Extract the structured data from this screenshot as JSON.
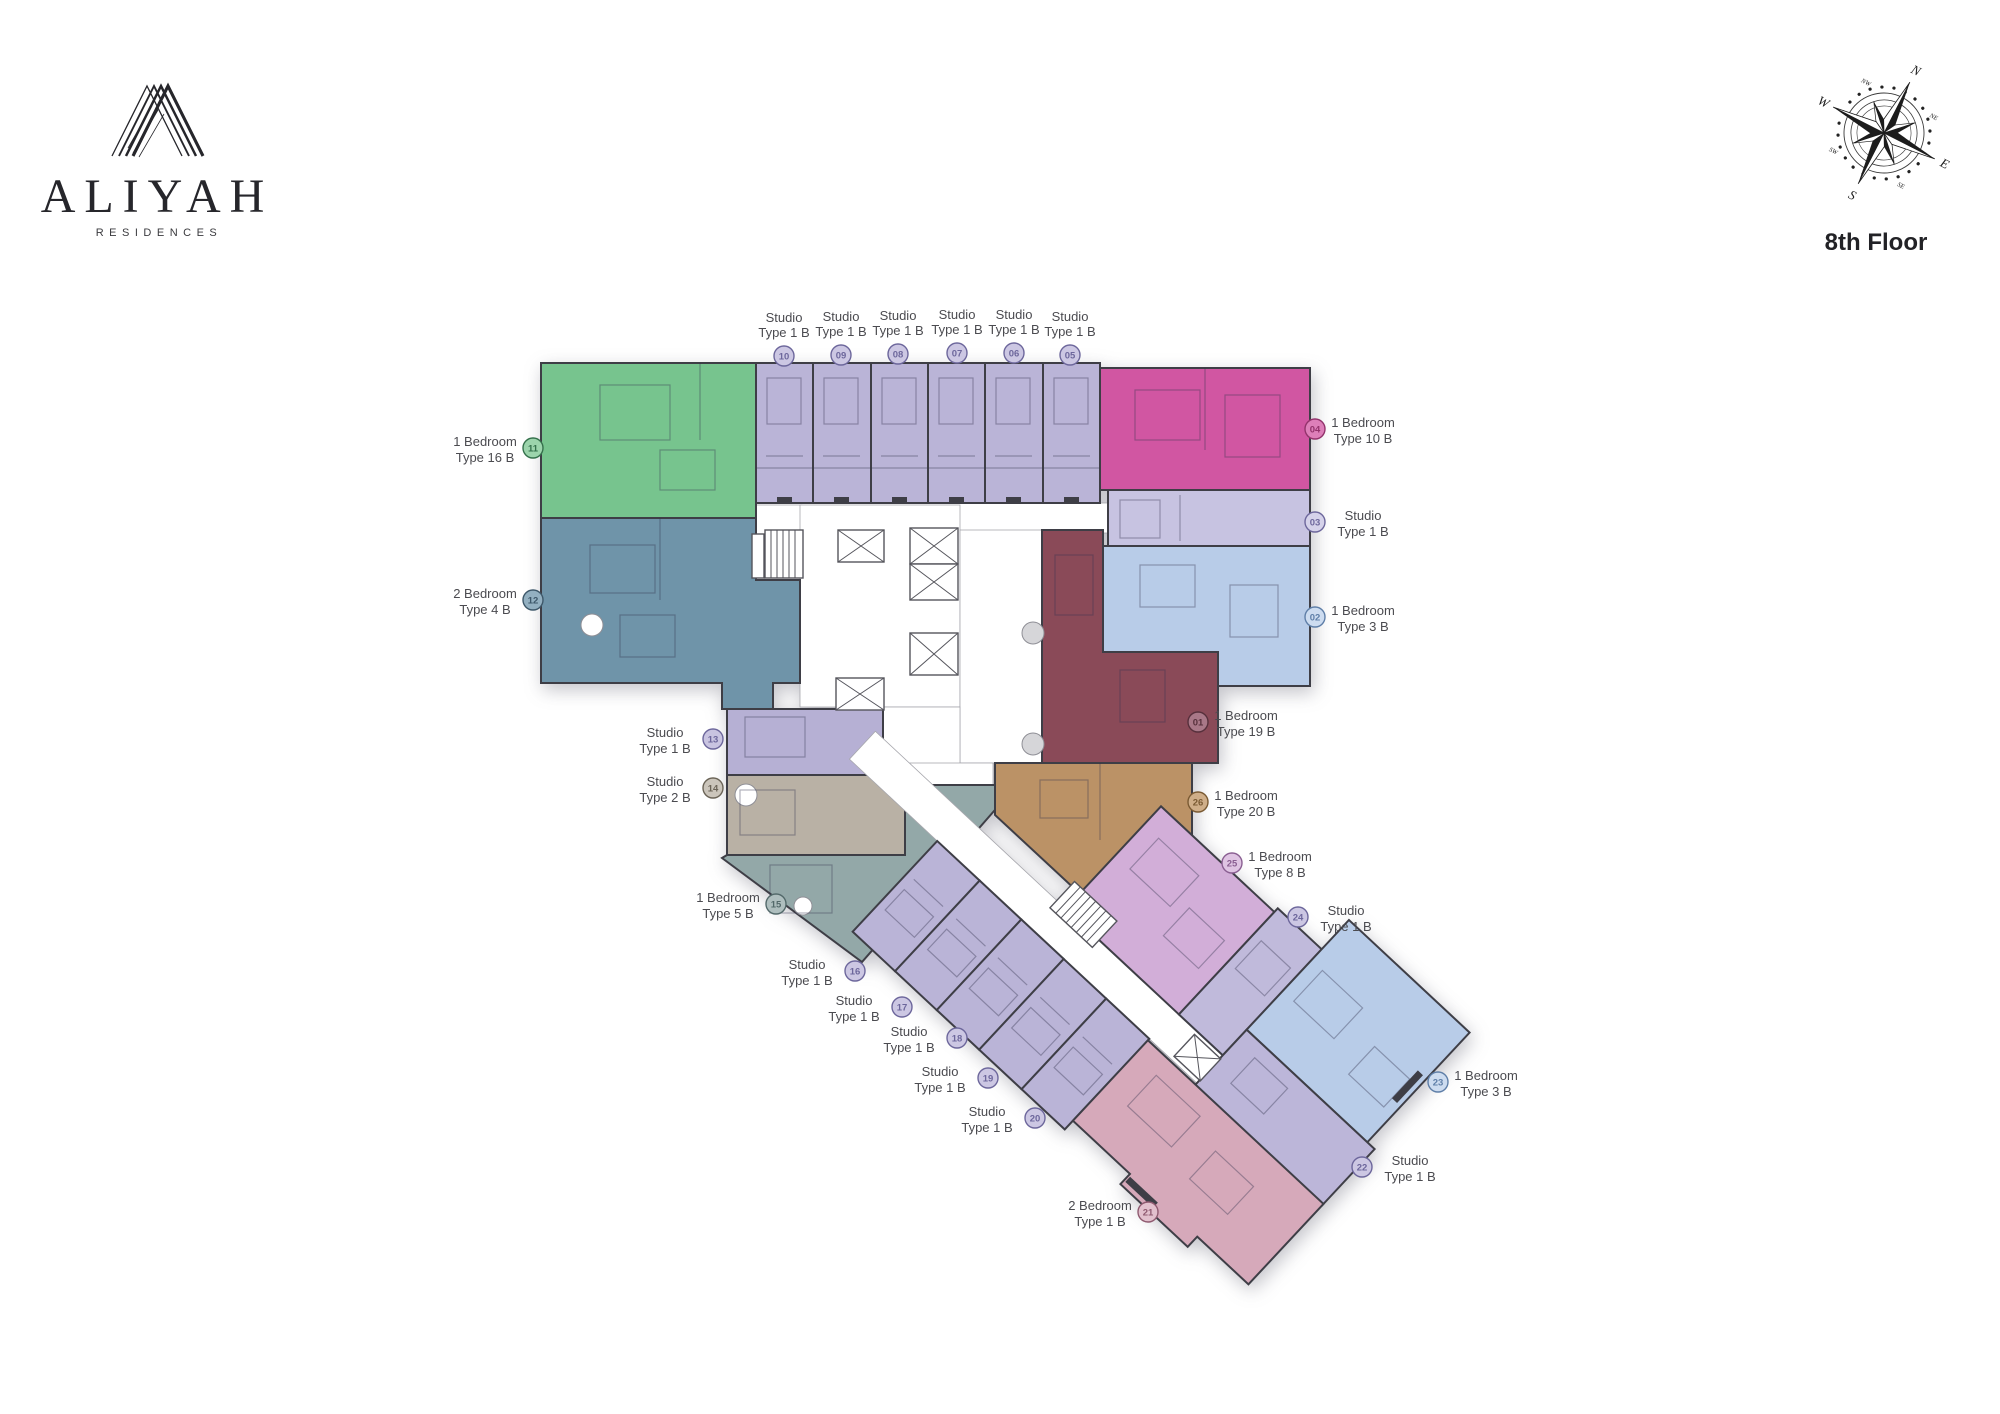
{
  "brand": {
    "name": "ALIYAH",
    "tagline": "RESIDENCES"
  },
  "floor": {
    "label": "8th Floor"
  },
  "compass": {
    "n": "N",
    "e": "E",
    "s": "S",
    "w": "W",
    "ne": "NE",
    "se": "SE",
    "sw": "SW",
    "nw": "NW"
  },
  "palette": {
    "wall": "#3e3e46",
    "label_text": "#4b4b50"
  },
  "units": {
    "u01": {
      "number": "01",
      "label1": "1 Bedroom",
      "label2": "Type 19 B",
      "color": "#8a4a58",
      "badge_fill": "#a97888",
      "badge_stroke": "#57303c"
    },
    "u02": {
      "number": "02",
      "label1": "1 Bedroom",
      "label2": "Type 3 B",
      "color": "#b8cce8",
      "badge_fill": "#cddcf0",
      "badge_stroke": "#5f7fa8"
    },
    "u03": {
      "number": "03",
      "label1": "Studio",
      "label2": "Type 1 B",
      "color": "#c7c3e1",
      "badge_fill": "#d5d2ea",
      "badge_stroke": "#6d679c"
    },
    "u04": {
      "number": "04",
      "label1": "1 Bedroom",
      "label2": "Type 10 B",
      "color": "#d156a2",
      "badge_fill": "#dd7fb9",
      "badge_stroke": "#93336c"
    },
    "u05": {
      "number": "05",
      "label1": "Studio",
      "label2": "Type 1 B",
      "color": "#bab4d7",
      "badge_fill": "#ccc7e3",
      "badge_stroke": "#6d679c"
    },
    "u06": {
      "number": "06",
      "label1": "Studio",
      "label2": "Type 1 B",
      "color": "#bab4d7",
      "badge_fill": "#ccc7e3",
      "badge_stroke": "#6d679c"
    },
    "u07": {
      "number": "07",
      "label1": "Studio",
      "label2": "Type 1 B",
      "color": "#bab4d7",
      "badge_fill": "#ccc7e3",
      "badge_stroke": "#6d679c"
    },
    "u08": {
      "number": "08",
      "label1": "Studio",
      "label2": "Type 1 B",
      "color": "#bab4d7",
      "badge_fill": "#ccc7e3",
      "badge_stroke": "#6d679c"
    },
    "u09": {
      "number": "09",
      "label1": "Studio",
      "label2": "Type 1 B",
      "color": "#bab4d7",
      "badge_fill": "#ccc7e3",
      "badge_stroke": "#6d679c"
    },
    "u10": {
      "number": "10",
      "label1": "Studio",
      "label2": "Type 1 B",
      "color": "#bab4d7",
      "badge_fill": "#ccc7e3",
      "badge_stroke": "#6d679c"
    },
    "u11": {
      "number": "11",
      "label1": "1 Bedroom",
      "label2": "Type 16 B",
      "color": "#77c48e",
      "badge_fill": "#9cd4ac",
      "badge_stroke": "#35714c"
    },
    "u12": {
      "number": "12",
      "label1": "2 Bedroom",
      "label2": "Type 4 B",
      "color": "#6f94a9",
      "badge_fill": "#93b0c1",
      "badge_stroke": "#3e586a"
    },
    "u13": {
      "number": "13",
      "label1": "Studio",
      "label2": "Type 1 B",
      "color": "#b6b0d4",
      "badge_fill": "#c9c4e1",
      "badge_stroke": "#6d679c"
    },
    "u14": {
      "number": "14",
      "label1": "Studio",
      "label2": "Type 2 B",
      "color": "#b9b1a5",
      "badge_fill": "#cbc5bb",
      "badge_stroke": "#6b6457"
    },
    "u15": {
      "number": "15",
      "label1": "1 Bedroom",
      "label2": "Type 5 B",
      "color": "#93a8a8",
      "badge_fill": "#aebebe",
      "badge_stroke": "#53696a"
    },
    "u16": {
      "number": "16",
      "label1": "Studio",
      "label2": "Type 1 B",
      "color": "#bab4d7",
      "badge_fill": "#ccc7e3",
      "badge_stroke": "#6d679c"
    },
    "u17": {
      "number": "17",
      "label1": "Studio",
      "label2": "Type 1 B",
      "color": "#bab4d7",
      "badge_fill": "#ccc7e3",
      "badge_stroke": "#6d679c"
    },
    "u18": {
      "number": "18",
      "label1": "Studio",
      "label2": "Type 1 B",
      "color": "#bab4d7",
      "badge_fill": "#ccc7e3",
      "badge_stroke": "#6d679c"
    },
    "u19": {
      "number": "19",
      "label1": "Studio",
      "label2": "Type 1 B",
      "color": "#bab4d7",
      "badge_fill": "#ccc7e3",
      "badge_stroke": "#6d679c"
    },
    "u20": {
      "number": "20",
      "label1": "Studio",
      "label2": "Type 1 B",
      "color": "#bab4d7",
      "badge_fill": "#ccc7e3",
      "badge_stroke": "#6d679c"
    },
    "u21": {
      "number": "21",
      "label1": "2 Bedroom",
      "label2": "Type 1 B",
      "color": "#d6a9ba",
      "badge_fill": "#e2c0cd",
      "badge_stroke": "#8f5a70"
    },
    "u22": {
      "number": "22",
      "label1": "Studio",
      "label2": "Type 1 B",
      "color": "#bcb6d9",
      "badge_fill": "#ccc7e3",
      "badge_stroke": "#6d679c"
    },
    "u23": {
      "number": "23",
      "label1": "1 Bedroom",
      "label2": "Type 3 B",
      "color": "#b8cce8",
      "badge_fill": "#cddcf0",
      "badge_stroke": "#5f7fa8"
    },
    "u24": {
      "number": "24",
      "label1": "Studio",
      "label2": "Type 1 B",
      "color": "#c0badb",
      "badge_fill": "#ccc7e3",
      "badge_stroke": "#6d679c"
    },
    "u25": {
      "number": "25",
      "label1": "1 Bedroom",
      "label2": "Type 8 B",
      "color": "#d2aed8",
      "badge_fill": "#dfc4e3",
      "badge_stroke": "#8a5f92"
    },
    "u26": {
      "number": "26",
      "label1": "1 Bedroom",
      "label2": "Type 20 B",
      "color": "#bb9266",
      "badge_fill": "#cfae89",
      "badge_stroke": "#7a5a33"
    }
  }
}
